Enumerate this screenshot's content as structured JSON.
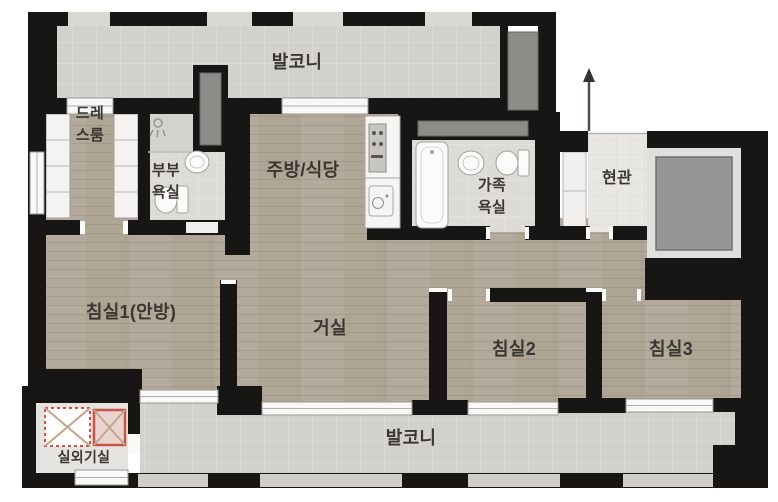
{
  "floorplan": {
    "type": "apartment-floor-plan",
    "rooms": {
      "balcony_top": "발코니",
      "dress_room": "드레스룸",
      "master_bathroom": "부부욕실",
      "kitchen_dining": "주방/식당",
      "family_bathroom": "가족욕실",
      "entrance": "현관",
      "bedroom1": "침실1(안방)",
      "living_room": "거실",
      "bedroom2": "침실2",
      "bedroom3": "침실3",
      "balcony_bottom": "발코니",
      "outdoor_unit_room": "실외기실"
    },
    "icons": {
      "entrance_arrow": "up-arrow entry direction",
      "outdoor_unit_symbols": "two squares with X (AC outdoor units)",
      "fixtures": "bathtub, toilets, washbasins, shower, kitchen counter, wardrobes"
    },
    "colors": {
      "wall": "#181614",
      "wood_floor": "#b3aa9b",
      "balcony_tile": "#d3d1cb",
      "bath_tile": "#dddbd6",
      "entrance_tile": "#e8e7e4",
      "shaft_grey": "#8e8c88",
      "elevator_grey": "#979593",
      "ac_unit_red": "#c9544b",
      "ac_cross_tan": "#c4a58c",
      "label_text": "#3a3732",
      "background": "#ffffff"
    }
  }
}
